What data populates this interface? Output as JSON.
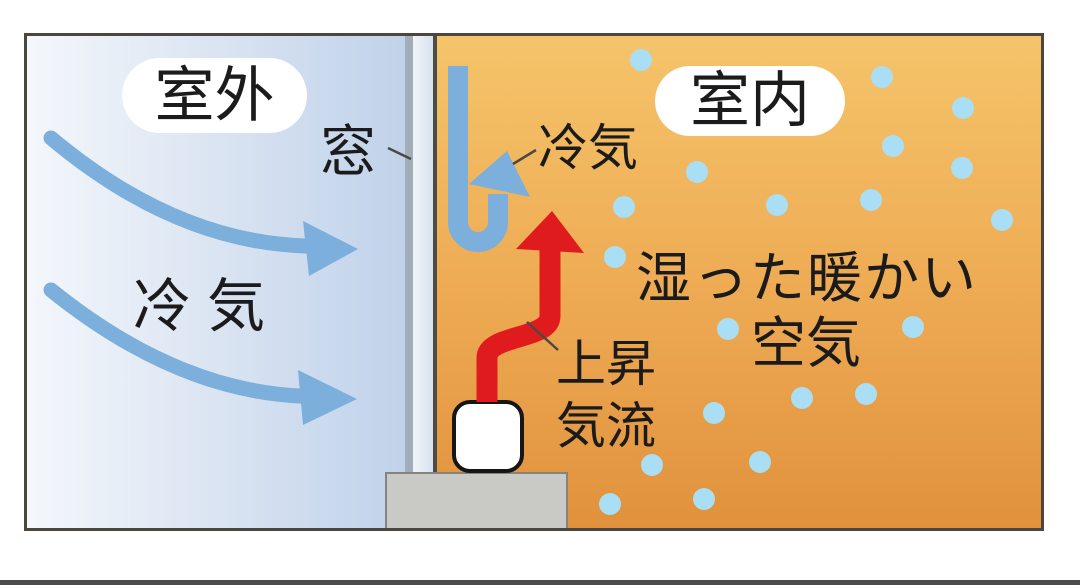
{
  "diagram": {
    "outdoor_label": "室外",
    "indoor_label": "室内",
    "window_label": "窓",
    "outdoor_cold_air_label": "冷 気",
    "indoor_cold_air_label": "冷気",
    "updraft_label": "上昇気流",
    "updraft_line1": "上昇",
    "updraft_line2": "気流",
    "moist_warm_air_line1": "湿った暖かい",
    "moist_warm_air_line2": "空気"
  },
  "colors": {
    "cold_arrow": "#7cafdb",
    "updraft_arrow": "#e01b1e",
    "droplet": "#aadef5",
    "pointer_line": "#4a4a42",
    "outdoor_bg_start": "#f4f7fb",
    "outdoor_bg_end": "#c0d2ea",
    "indoor_bg_start": "#f5c46a",
    "indoor_bg_end": "#e1913c",
    "frame_border": "#4c463e",
    "sill_gray": "#c9c9c6"
  },
  "droplets": [
    [
      641,
      60
    ],
    [
      882,
      77
    ],
    [
      963,
      108
    ],
    [
      893,
      146
    ],
    [
      962,
      168
    ],
    [
      697,
      172
    ],
    [
      624,
      207
    ],
    [
      777,
      205
    ],
    [
      871,
      200
    ],
    [
      1002,
      220
    ],
    [
      615,
      257
    ],
    [
      728,
      329
    ],
    [
      913,
      327
    ],
    [
      802,
      398
    ],
    [
      866,
      394
    ],
    [
      714,
      413
    ],
    [
      760,
      462
    ],
    [
      652,
      465
    ],
    [
      704,
      499
    ],
    [
      610,
      504
    ]
  ]
}
